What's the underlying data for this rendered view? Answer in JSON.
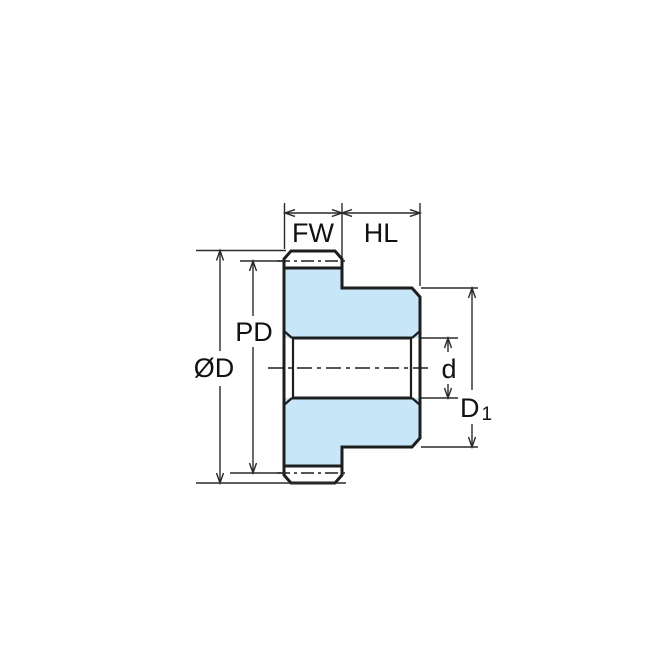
{
  "colors": {
    "part_fill": "#C7E6F7",
    "line": "#1E1E1E",
    "dimension_line": "#2A2A2A",
    "background": "#FFFFFF"
  },
  "labels": {
    "face_width": "FW",
    "hub_length": "HL",
    "pitch_diameter": "PD",
    "outside_diameter": "ØD",
    "bore_diameter": "d",
    "hub_diameter_base": "D",
    "hub_diameter_subscript": "1"
  }
}
